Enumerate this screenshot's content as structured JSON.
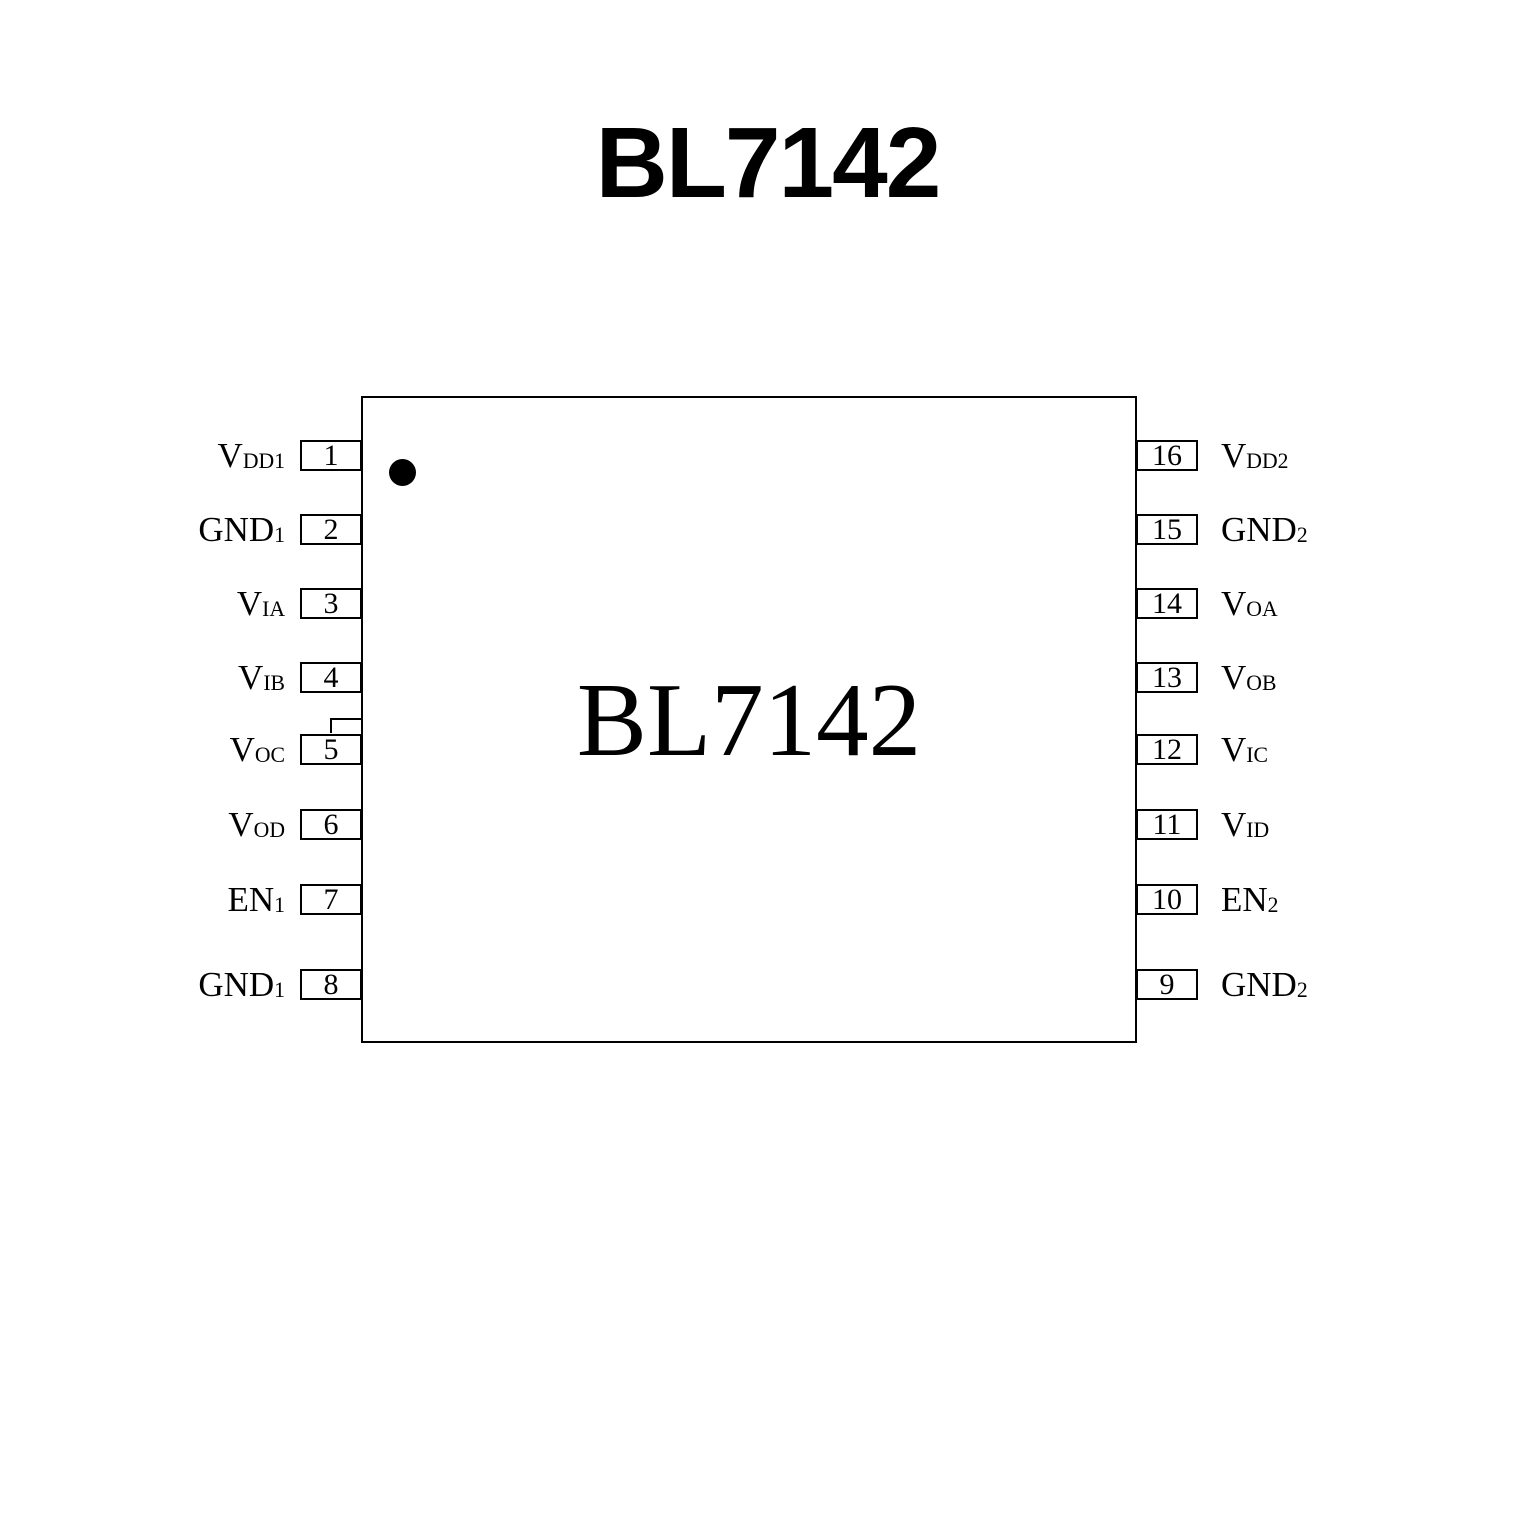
{
  "title": "BL7142",
  "chip": {
    "label": "BL7142"
  },
  "icons": {
    "pin1_indicator": "filled-black-dot"
  },
  "colors": {
    "line": "#000000",
    "background": "#ffffff",
    "text": "#000000"
  },
  "pins": {
    "left": [
      {
        "number": "1",
        "base": "V",
        "sub": "DD1"
      },
      {
        "number": "2",
        "base": "GND",
        "sub": "1"
      },
      {
        "number": "3",
        "base": "V",
        "sub": "IA"
      },
      {
        "number": "4",
        "base": "V",
        "sub": "IB"
      },
      {
        "number": "5",
        "base": "V",
        "sub": "OC"
      },
      {
        "number": "6",
        "base": "V",
        "sub": "OD"
      },
      {
        "number": "7",
        "base": "EN",
        "sub": "1"
      },
      {
        "number": "8",
        "base": "GND",
        "sub": "1"
      }
    ],
    "right": [
      {
        "number": "16",
        "base": "V",
        "sub": "DD2"
      },
      {
        "number": "15",
        "base": "GND",
        "sub": "2"
      },
      {
        "number": "14",
        "base": "V",
        "sub": "OA"
      },
      {
        "number": "13",
        "base": "V",
        "sub": "OB"
      },
      {
        "number": "12",
        "base": "V",
        "sub": "IC"
      },
      {
        "number": "11",
        "base": "V",
        "sub": "ID"
      },
      {
        "number": "10",
        "base": "EN",
        "sub": "2"
      },
      {
        "number": "9",
        "base": "GND",
        "sub": "2"
      }
    ]
  }
}
